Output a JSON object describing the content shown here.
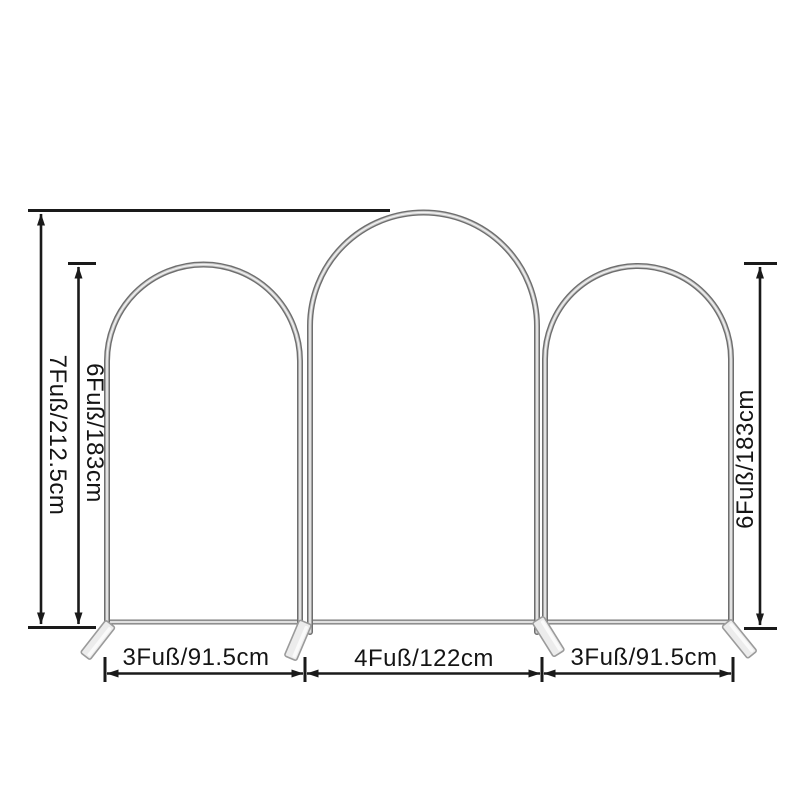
{
  "page": {
    "background": "#ffffff"
  },
  "diagram": {
    "frame_color": "#8d8d8d",
    "dimension_color": "#1a1a1a",
    "dimensions": {
      "overall_height": "7Fuß/212.5cm",
      "left_arch_height": "6Fuß/183cm",
      "right_arch_height": "6Fuß/183cm",
      "left_arch_width": "3Fuß/91.5cm",
      "middle_arch_width": "4Fuß/122cm",
      "right_arch_width": "3Fuß/91.5cm"
    }
  }
}
